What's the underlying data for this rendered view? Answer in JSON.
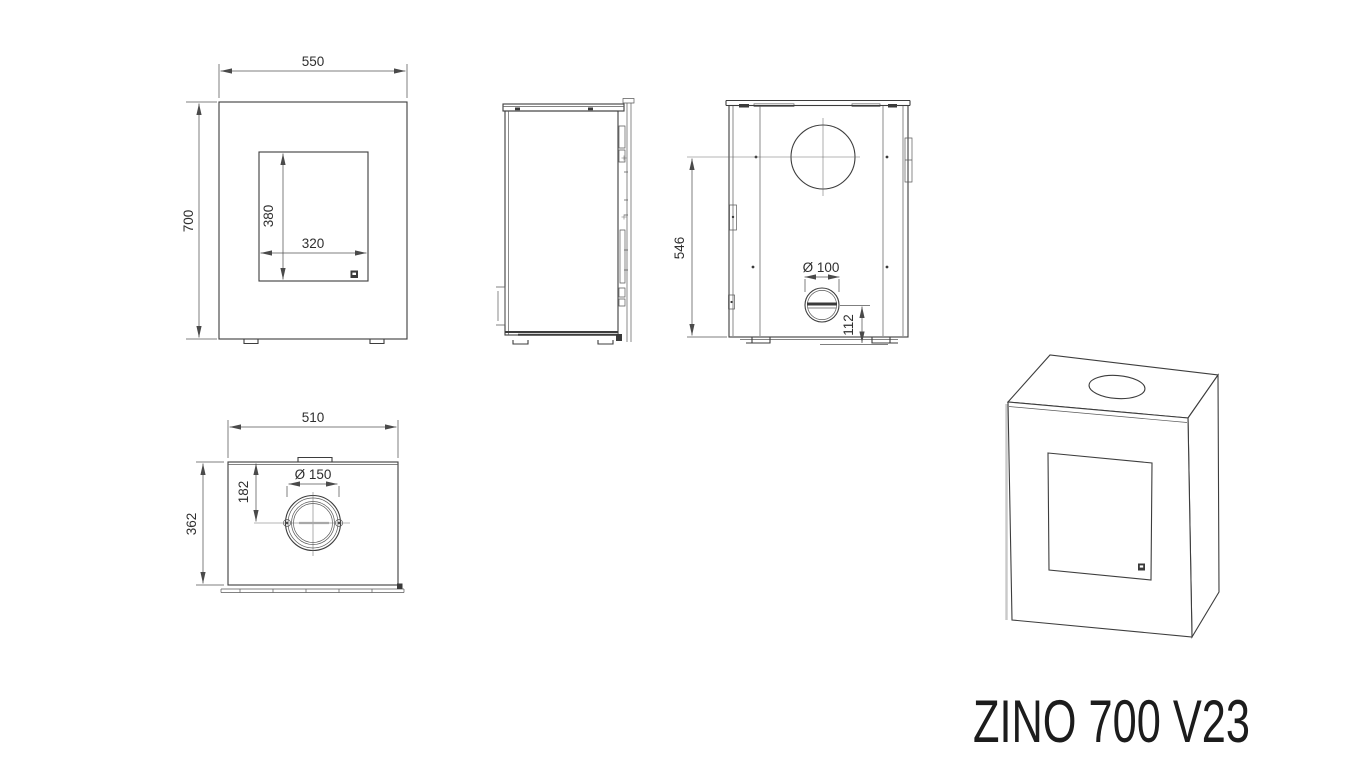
{
  "title_block": {
    "model_name": "ZINO 700 V23"
  },
  "front_view": {
    "overall_width": "550",
    "overall_height": "700",
    "glass_height": "380",
    "glass_width": "320"
  },
  "rear_view": {
    "flue_center_height": "546",
    "rear_port_diameter": "Ø 100",
    "rear_port_center_height": "112"
  },
  "top_view": {
    "body_width": "510",
    "flue_center_offset": "182",
    "flue_collar_diameter": "Ø 150",
    "body_depth": "362"
  }
}
